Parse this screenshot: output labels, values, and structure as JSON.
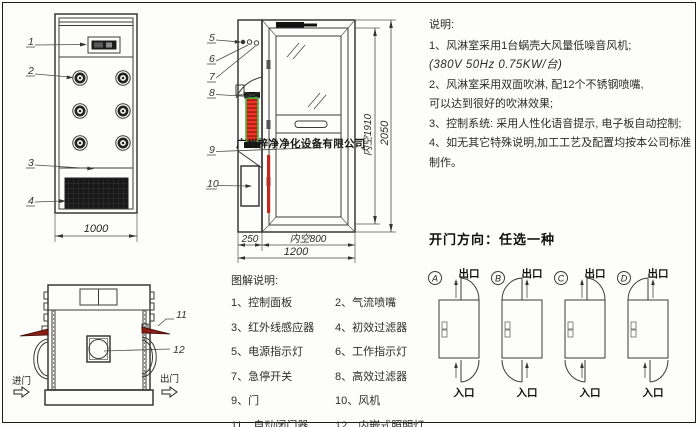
{
  "watermark": "广州梓净净化设备有限公司",
  "notes": {
    "title": "说明:",
    "lines": [
      "1、风淋室采用1台蜗壳大风量低噪音风机;",
      "(380V  50Hz  0.75KW/台)",
      "2、风淋室采用双面吹淋, 配12个不锈钢喷嘴,",
      "可以达到很好的吹淋效果;",
      "3、控制系统: 采用人性化语音提示, 电子板自动控制;",
      "4、如无其它特殊说明,加工工艺及配置均按本公司标准制作。"
    ]
  },
  "door_direction": {
    "title": "开门方向：任选一种",
    "exit": "出口",
    "entry": "入口",
    "options": [
      {
        "letter": "A"
      },
      {
        "letter": "B"
      },
      {
        "letter": "C"
      },
      {
        "letter": "D"
      }
    ]
  },
  "legend": {
    "title": "图解说明:",
    "items": [
      "1、控制面板",
      "2、气流喷嘴",
      "3、红外线感应器",
      "4、初效过滤器",
      "5、电源指示灯",
      "6、工作指示灯",
      "7、急停开关",
      "8、高效过滤器",
      "9、门",
      "10、风机",
      "11、自动闭门器",
      "12、内嵌式照明灯"
    ]
  },
  "front_view": {
    "callouts": [
      "1",
      "2",
      "3",
      "4"
    ],
    "width_dim": "1000"
  },
  "door_view": {
    "callouts": [
      "5",
      "6",
      "7",
      "8",
      "9",
      "10"
    ],
    "dims": {
      "left_width": "250",
      "inner_width": "内空800",
      "total_width": "1200",
      "inner_height": "内空1910",
      "total_height": "2050"
    }
  },
  "top_view": {
    "callouts": [
      "11",
      "12"
    ],
    "entry": "进门",
    "exit": "出门"
  },
  "colors": {
    "line": "#3a3a3a",
    "filter_red": "#e8372a",
    "filter_green": "#3fbf3f",
    "closer_red": "#8a1d12"
  }
}
